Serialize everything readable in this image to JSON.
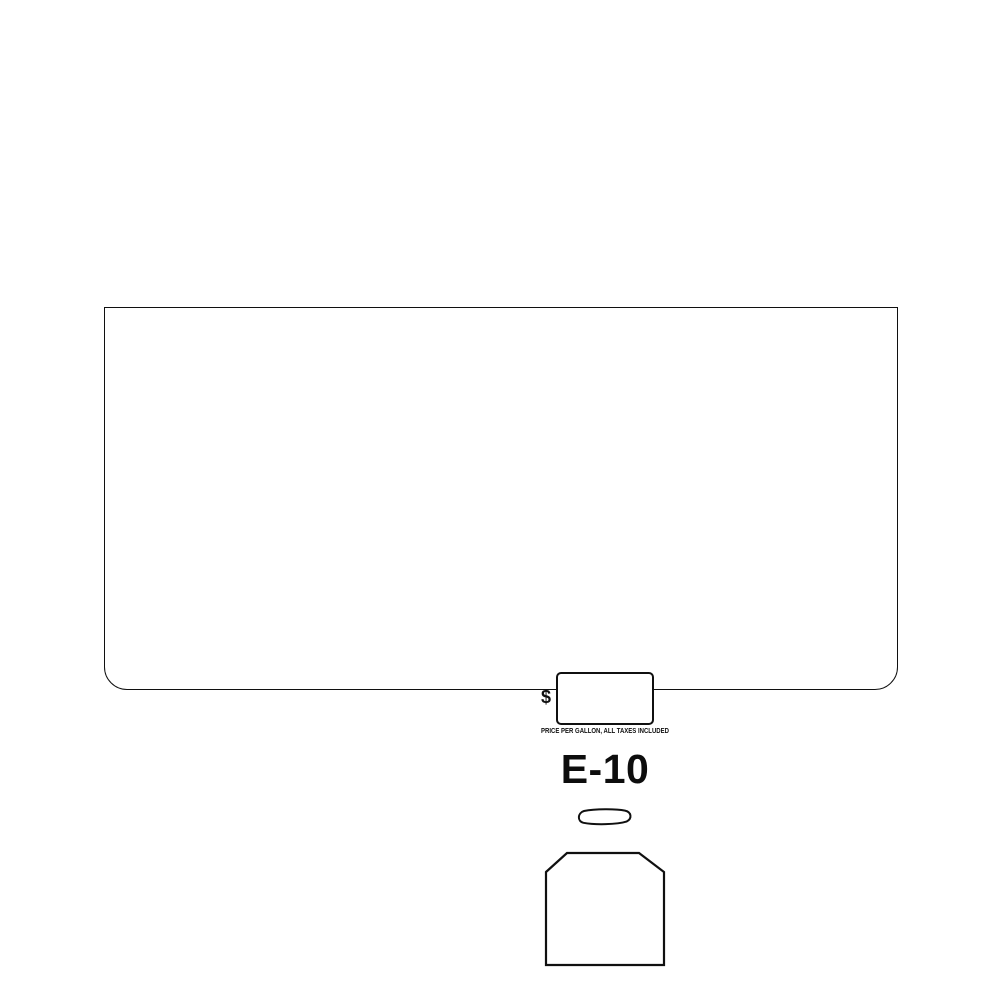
{
  "drawing": {
    "background_color": "#ffffff",
    "line_color": "#101010",
    "dollar_sign": "$",
    "price_caption": "PRICE PER GALLON, ALL TAXES INCLUDED",
    "grade_label": "E-10",
    "shapes": [
      {
        "name": "bezel-outline",
        "type": "rounded-bottom-rectangle"
      },
      {
        "name": "price-display-window-cutout",
        "type": "rounded-rectangle"
      },
      {
        "name": "pushbutton-cutout",
        "type": "pill"
      },
      {
        "name": "nozzle-boot-cutout",
        "type": "chamfered-rectangle"
      }
    ]
  }
}
